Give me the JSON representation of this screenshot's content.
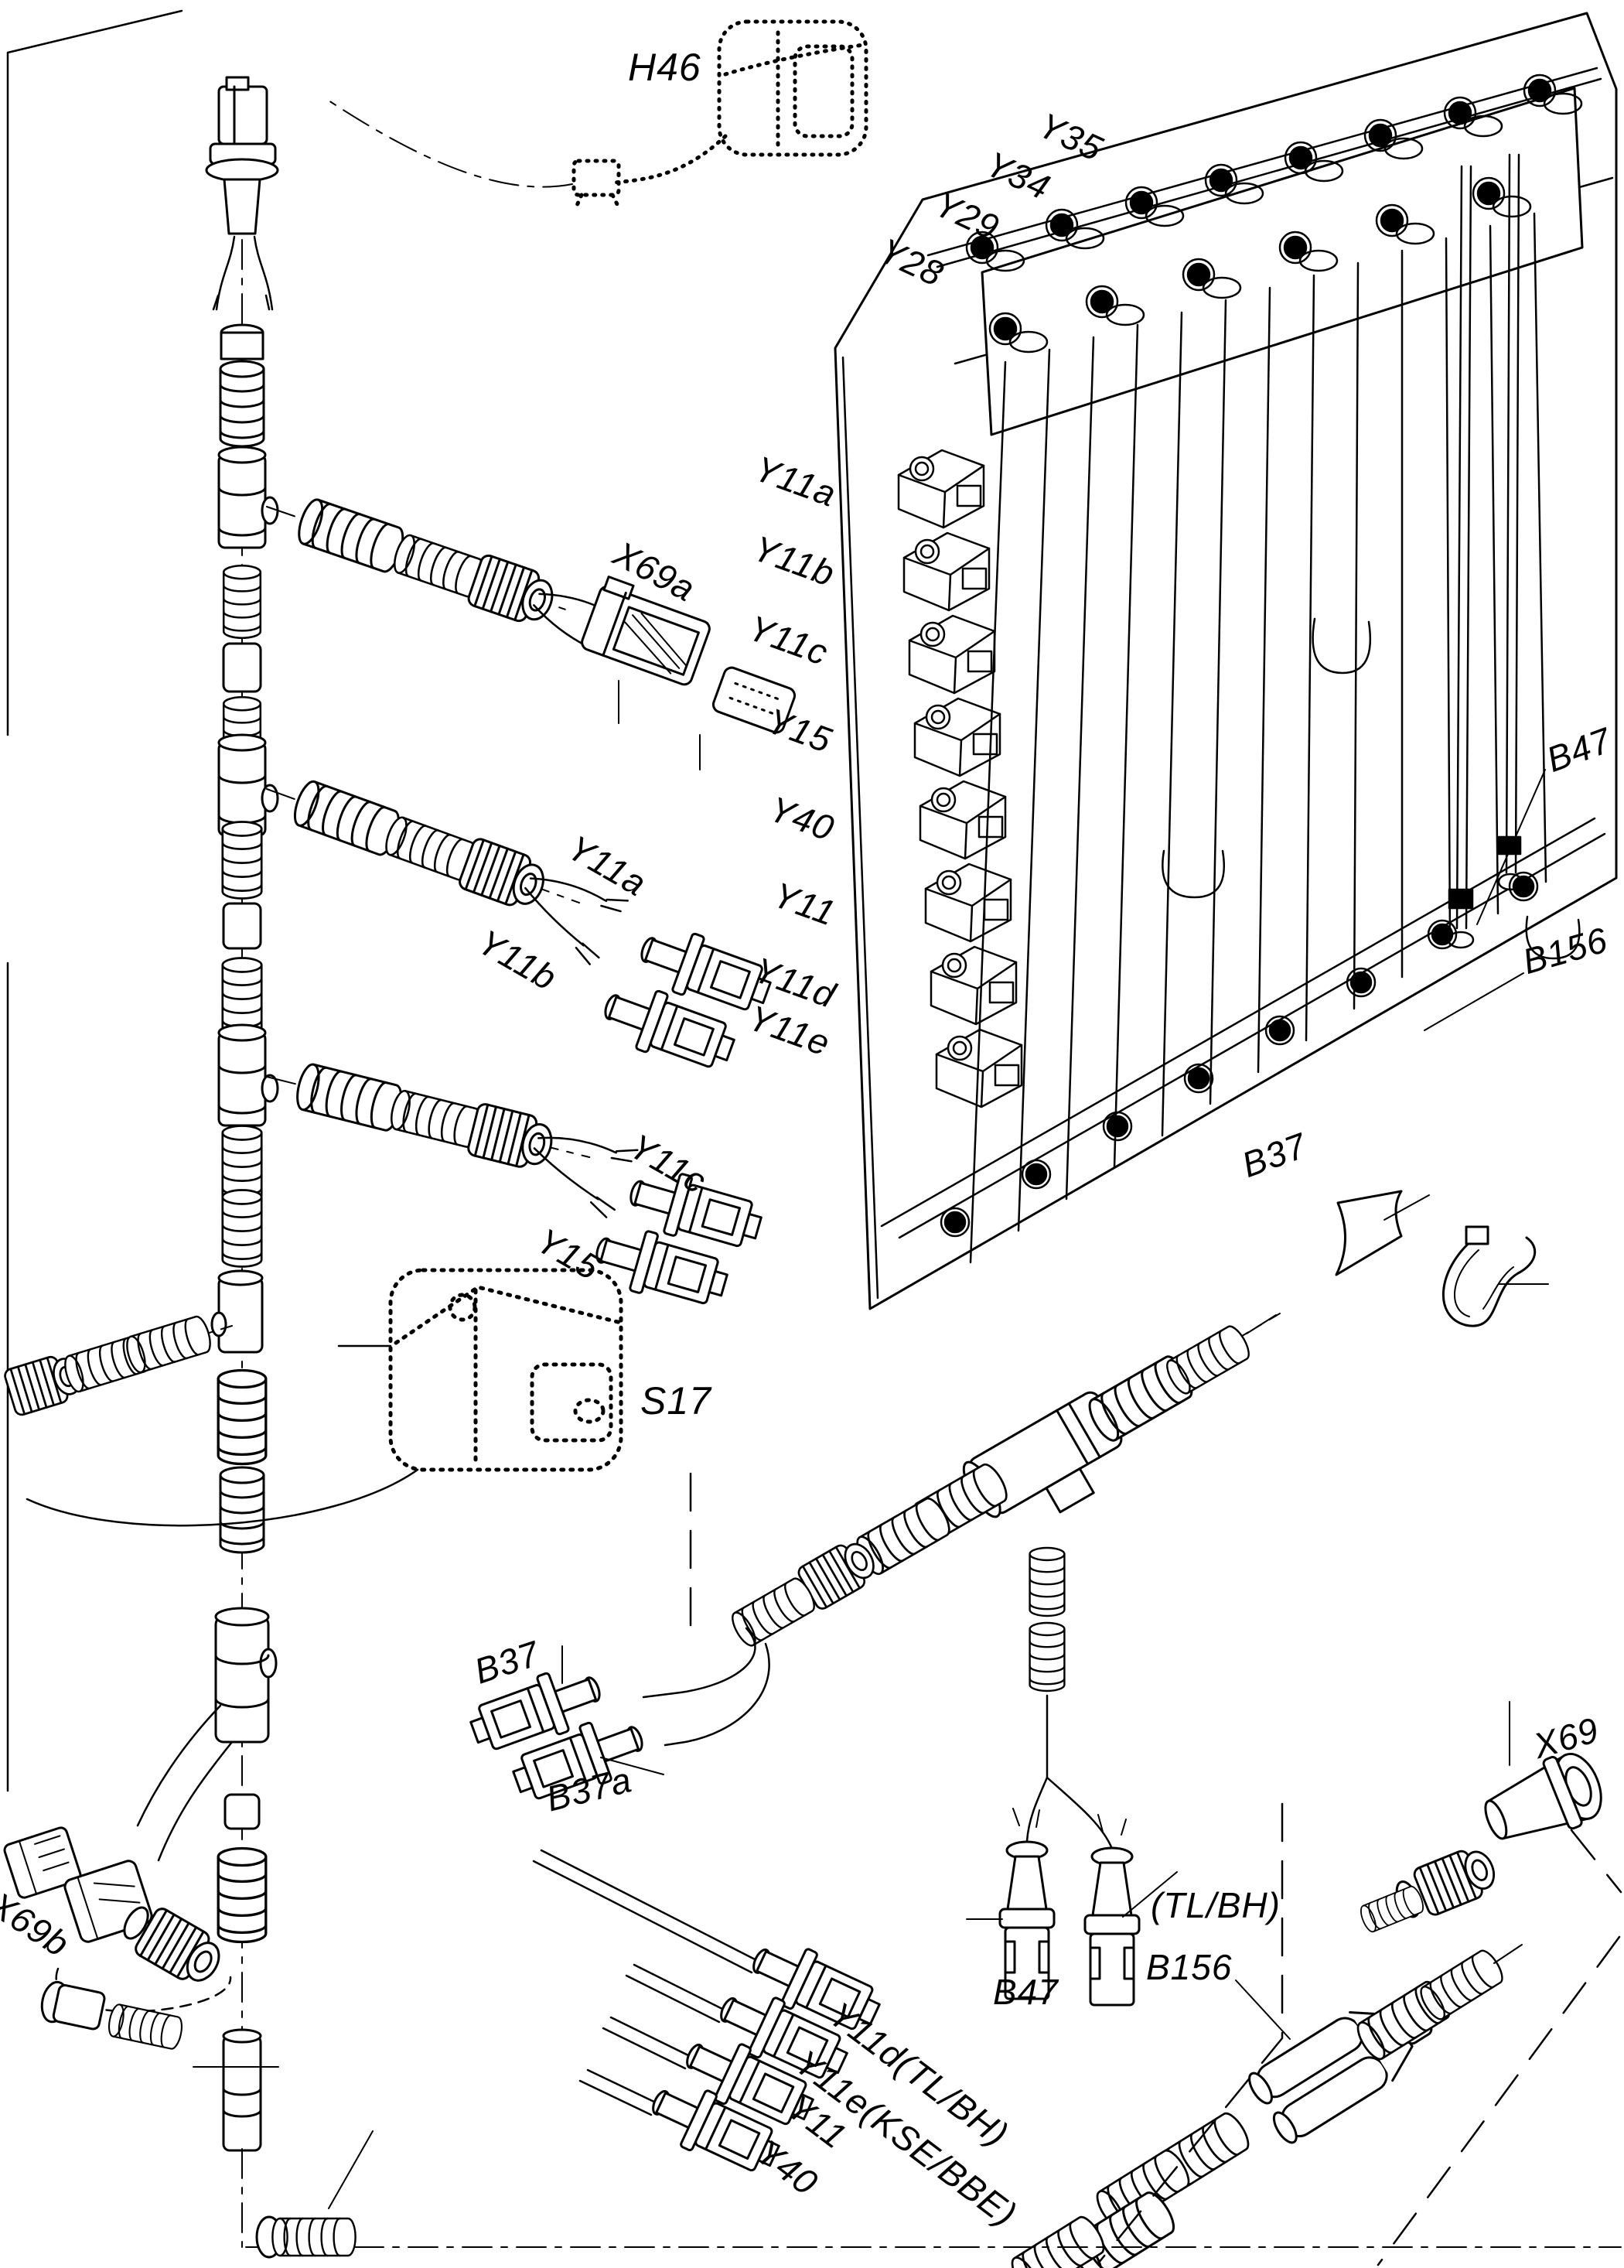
{
  "colors": {
    "line": "#000000",
    "background": "#ffffff"
  },
  "labels": {
    "h46": "H46",
    "y35": "Y35",
    "y34": "Y34",
    "y29": "Y29",
    "y28": "Y28",
    "col_y11a": "Y11a",
    "col_y11b": "Y11b",
    "col_y11c": "Y11c",
    "col_y15": "Y15",
    "col_y40": "Y40",
    "col_y11": "Y11",
    "col_y11d": "Y11d",
    "col_y11e": "Y11e",
    "x69a": "X69a",
    "b47_block": "B47",
    "b156_block": "B156",
    "b37_block": "B37",
    "mid_y11a": "Y11a",
    "mid_y11b": "Y11b",
    "mid_y11c": "Y11c",
    "mid_y15": "Y15",
    "s17": "S17",
    "b37_cable": "B37",
    "b37a_cable": "B37a",
    "x69": "X69",
    "tlbh": "(TL/BH)",
    "b156_cable": "B156",
    "b47_cable": "B47",
    "x69b": "X69b",
    "y11d_tlbh": "Y11d(TL/BH)",
    "y11e_ksebbe": "Y11e(KSE/BBE)",
    "y11_cable": "Y11",
    "y40_cable": "Y40"
  }
}
